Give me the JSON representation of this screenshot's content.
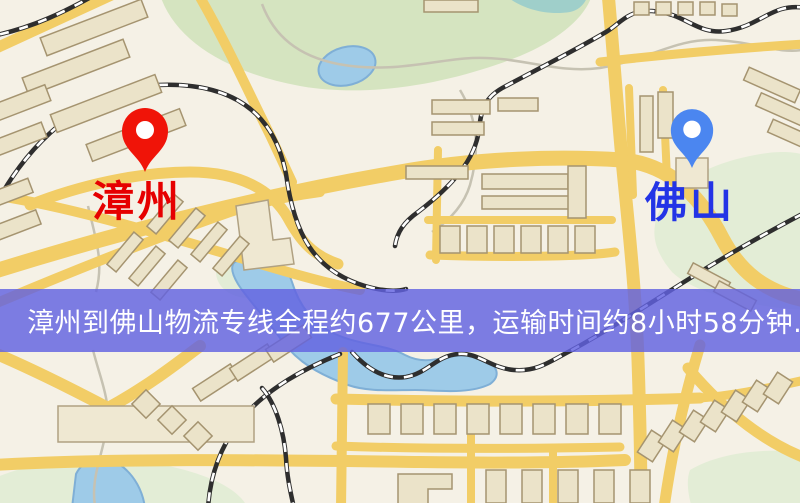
{
  "map": {
    "origin": {
      "label": "漳州",
      "marker_icon": "red-map-pin",
      "marker_color": "#f01408",
      "label_color": "#e60000"
    },
    "destination": {
      "label": "佛山",
      "marker_icon": "blue-map-pin",
      "marker_color": "#4b86f0",
      "label_color": "#2334e6"
    },
    "banner": {
      "text": "漳州到佛山物流专线全程约677公里，运输时间约8小时58分钟.",
      "distance_km": 677,
      "duration_hours": 8,
      "duration_minutes": 58,
      "overlay_color": "#6262e0",
      "text_color": "#ffffff"
    },
    "style_colors": {
      "background": "#f5f1e6",
      "road": "#f2cd66",
      "park": "#d5e4c0",
      "water": "#9ecbe8",
      "building": "#ebe3c9",
      "railway": "#2e2e2e"
    }
  }
}
